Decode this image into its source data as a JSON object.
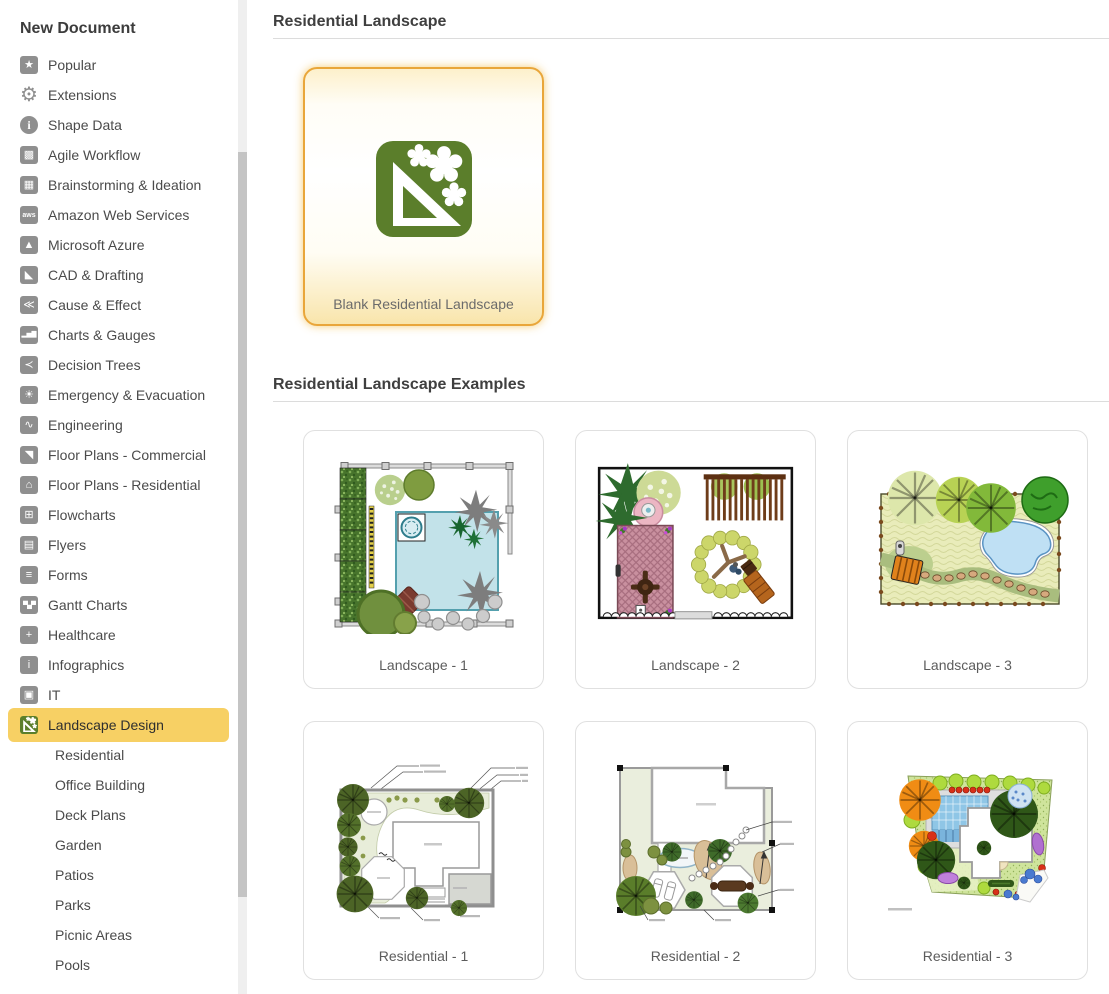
{
  "sidebar": {
    "title": "New Document",
    "items": [
      {
        "label": "Popular",
        "icon": "star-icon",
        "glyph": "★"
      },
      {
        "label": "Extensions",
        "icon": "gear-icon",
        "glyph": "⚙"
      },
      {
        "label": "Shape Data",
        "icon": "info-circle-icon",
        "glyph": "i"
      },
      {
        "label": "Agile Workflow",
        "icon": "kanban-icon",
        "glyph": "▩"
      },
      {
        "label": "Brainstorming & Ideation",
        "icon": "grid-icon",
        "glyph": "▦"
      },
      {
        "label": "Amazon Web Services",
        "icon": "aws-icon",
        "glyph": "aws"
      },
      {
        "label": "Microsoft Azure",
        "icon": "azure-icon",
        "glyph": "▲"
      },
      {
        "label": "CAD & Drafting",
        "icon": "set-square-icon",
        "glyph": "◣"
      },
      {
        "label": "Cause & Effect",
        "icon": "fishbone-icon",
        "glyph": "≪"
      },
      {
        "label": "Charts & Gauges",
        "icon": "bar-chart-icon",
        "glyph": "▂▅▇"
      },
      {
        "label": "Decision Trees",
        "icon": "branch-icon",
        "glyph": "≺"
      },
      {
        "label": "Emergency & Evacuation",
        "icon": "alarm-icon",
        "glyph": "☀"
      },
      {
        "label": "Engineering",
        "icon": "waveform-icon",
        "glyph": "∿"
      },
      {
        "label": "Floor Plans - Commercial",
        "icon": "ruler-icon",
        "glyph": "◥"
      },
      {
        "label": "Floor Plans - Residential",
        "icon": "house-icon",
        "glyph": "⌂"
      },
      {
        "label": "Flowcharts",
        "icon": "flowchart-icon",
        "glyph": "⊞"
      },
      {
        "label": "Flyers",
        "icon": "flyer-icon",
        "glyph": "▤"
      },
      {
        "label": "Forms",
        "icon": "form-icon",
        "glyph": "≡"
      },
      {
        "label": "Gantt Charts",
        "icon": "gantt-icon",
        "glyph": "▀▄▀"
      },
      {
        "label": "Healthcare",
        "icon": "plus-icon",
        "glyph": "+"
      },
      {
        "label": "Infographics",
        "icon": "info-square-icon",
        "glyph": "i"
      },
      {
        "label": "IT",
        "icon": "network-icon",
        "glyph": "▣"
      },
      {
        "label": "Landscape Design",
        "icon": "landscape-design-icon",
        "glyph": ""
      }
    ],
    "active_item": "Landscape Design",
    "sub_items": [
      {
        "label": "Residential"
      },
      {
        "label": "Office Building"
      },
      {
        "label": "Deck Plans"
      },
      {
        "label": "Garden"
      },
      {
        "label": "Patios"
      },
      {
        "label": "Parks"
      },
      {
        "label": "Picnic Areas"
      },
      {
        "label": "Pools"
      }
    ]
  },
  "main": {
    "section_blank": {
      "title": "Residential Landscape"
    },
    "blank_card": {
      "label": "Blank Residential Landscape",
      "icon": "landscape-design-icon"
    },
    "section_examples": {
      "title": "Residential Landscape Examples"
    },
    "example_cards": [
      {
        "label": "Landscape - 1"
      },
      {
        "label": "Landscape - 2"
      },
      {
        "label": "Landscape - 3"
      },
      {
        "label": "Residential - 1"
      },
      {
        "label": "Residential - 2"
      },
      {
        "label": "Residential - 3"
      }
    ]
  },
  "colors": {
    "accent_green": "#5b7e2b",
    "active_highlight": "#f7d064",
    "blank_card_border": "#e9a63a",
    "scrollbar_thumb": "#c4c4c4"
  }
}
